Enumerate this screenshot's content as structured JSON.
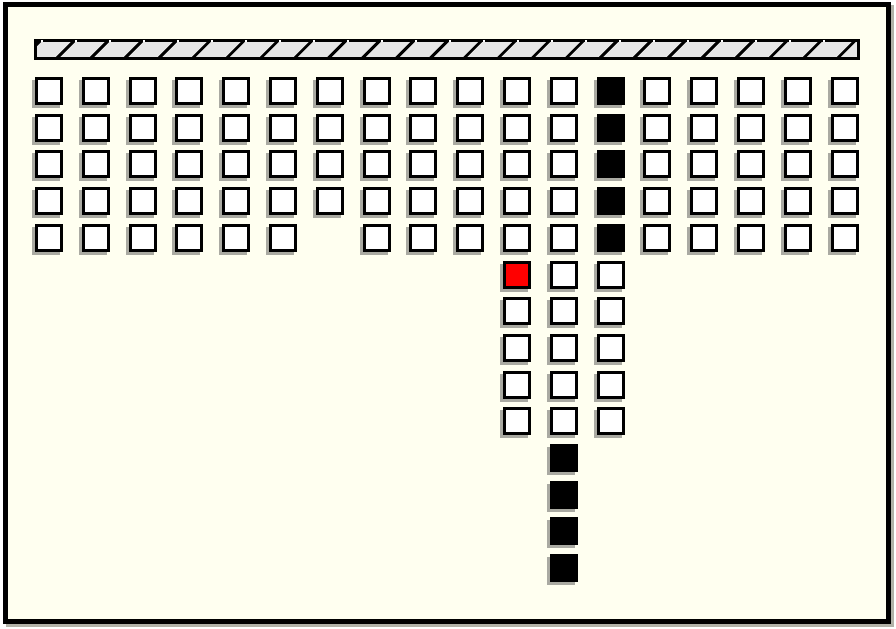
{
  "window": {
    "page_bg": "#ffffff",
    "bg": "#fffff0",
    "frame_color": "#000000",
    "frame_shadow_color": "#b2b2a8"
  },
  "ceiling": {
    "x": 34,
    "y": 39,
    "width": 826,
    "height": 21,
    "cell_color": "#e6e6e6",
    "frame_color": "#000000",
    "stripe_pitch_px": 34,
    "stripe_direction": "forward-slash"
  },
  "board": {
    "cols": 18,
    "rows": 14,
    "origin_x": 35,
    "origin_y": 77,
    "cell_px": 28,
    "col_pitch_px": 46.8,
    "row_pitch_px": 36.7,
    "tile_border_color": "#000000",
    "tile_shadow_color": "#aaaaa2",
    "tile_colors": {
      "W": "#ffffff",
      "B": "#000000",
      "R": "#ff0000"
    },
    "legend": {
      "W": "white-tile",
      "B": "black-tile",
      "R": "red-tile",
      ".": "empty"
    },
    "map": [
      "WWWWWWWWWWWWBWWWWW",
      "WWWWWWWWWWWWBWWWWW",
      "WWWWWWWWWWWWBWWWWW",
      "WWWWWWWWWWWWBWWWWW",
      "WWWWWW.WWWWWBWWWWW",
      "..........RWW.....",
      "..........WWW.....",
      "..........WWW.....",
      "..........WWW.....",
      "..........WWW.....",
      "...........B......",
      "...........B......",
      "...........B......",
      "...........B......"
    ]
  }
}
